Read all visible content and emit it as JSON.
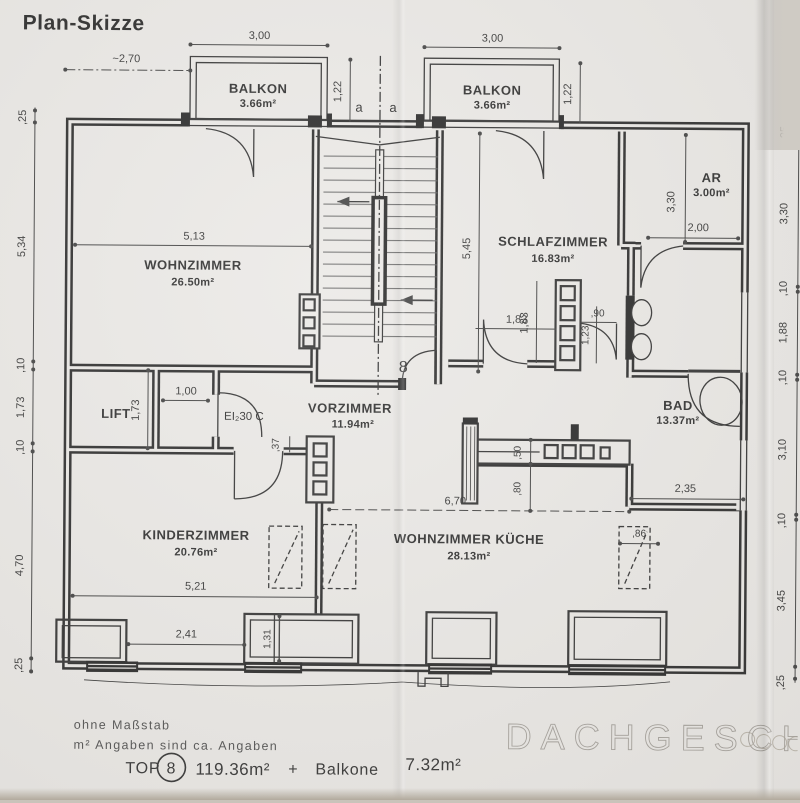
{
  "title": "Plan-Skizze",
  "watermark": "DACHGESCHOSS",
  "notes": {
    "no_scale": "ohne Maßstab",
    "approx": "m² Angaben sind ca. Angaben"
  },
  "summary": {
    "top_label": "TOP",
    "unit_number": "8",
    "unit_area": "119.36m²",
    "plus": "+",
    "balcony_label": "Balkone",
    "balcony_area": "7.32m²"
  },
  "rooms": {
    "balkon_left": {
      "name": "BALKON",
      "area": "3.66m²"
    },
    "balkon_right": {
      "name": "BALKON",
      "area": "3.66m²"
    },
    "wohnzimmer": {
      "name": "WOHNZIMMER",
      "area": "26.50m²"
    },
    "schlafzimmer": {
      "name": "SCHLAFZIMMER",
      "area": "16.83m²"
    },
    "abstellraum": {
      "name": "AR",
      "area": "3.00m²"
    },
    "bad": {
      "name": "BAD",
      "area": "13.37m²"
    },
    "vorzimmer": {
      "name": "VORZIMMER",
      "area": "11.94m²"
    },
    "kinderzimmer": {
      "name": "KINDERZIMMER",
      "area": "20.76m²"
    },
    "wohnzimmer_kueche": {
      "name": "WOHNZIMMER KÜCHE",
      "area": "28.13m²"
    },
    "lift": {
      "name": "LIFT"
    }
  },
  "labels": {
    "section_a_left": "a",
    "section_a_right": "a",
    "entry_unit_number": "8",
    "fire_door": "EI₂30 C"
  },
  "dims": {
    "approx_width": "~2,70",
    "balkon_left_width": "3,00",
    "balkon_right_width": "3,00",
    "balkon_left_depth": "1,22",
    "balkon_right_depth": "1,22",
    "left_chain": [
      ",25",
      "5,34",
      ",10",
      "1,73",
      ",10",
      "4,70",
      ",25"
    ],
    "right_chain": [
      ",25",
      "3,30",
      ",10",
      "1,88",
      ",10",
      "3,10",
      ",10",
      "3,45",
      ",25"
    ],
    "wohnzimmer_width": "5,13",
    "schlafzimmer_height": "5,45",
    "ar_height": "3,30",
    "ar_width": "2,00",
    "schlaf_closet_w": "1,83",
    "schlaf_closet_h": "1,83",
    "schlaf_door": ",90",
    "schlaf_shaft": "1,23",
    "lift_corridor": "1,00",
    "lift_depth": "1,73",
    "vorzimmer_wall": ",37",
    "cabinet_depth": ",50",
    "corridor_width": ",80",
    "open_span": "6,70",
    "bad_width": "2,35",
    "kinderzimmer_width": "5,21",
    "kinderzimmer_window": "2,41",
    "window_bay": "1,31",
    "skylight_width": ",86"
  }
}
